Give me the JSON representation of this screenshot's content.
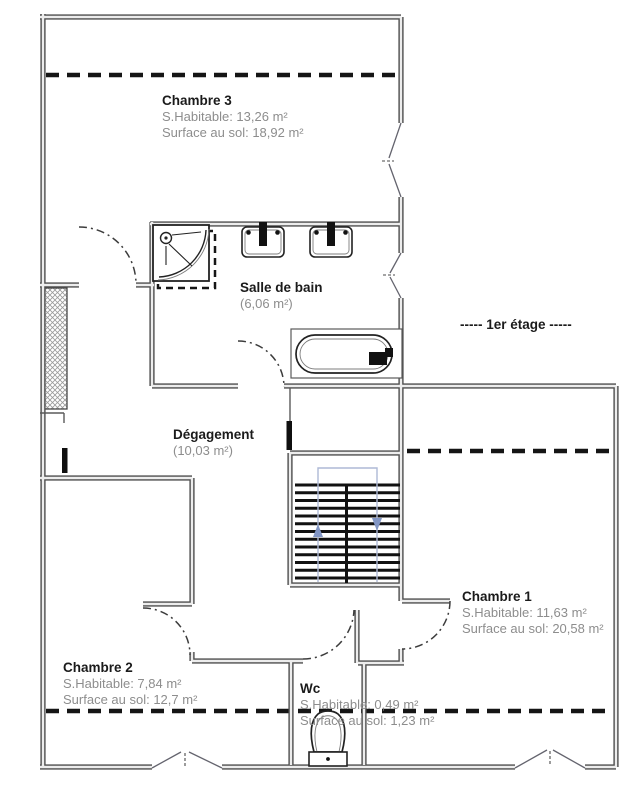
{
  "floor_label": "-----  1er étage  -----",
  "rooms": {
    "chambre3": {
      "name": "Chambre 3",
      "area_living": "S.Habitable: 13,26 m²",
      "area_floor": "Surface au sol: 18,92 m²"
    },
    "salle_de_bain": {
      "name": "Salle de bain",
      "area": "(6,06 m²)"
    },
    "degagement": {
      "name": "Dégagement",
      "area": "(10,03 m²)"
    },
    "chambre1": {
      "name": "Chambre 1",
      "area_living": "S.Habitable: 11,63 m²",
      "area_floor": "Surface au sol: 20,58 m²"
    },
    "chambre2": {
      "name": "Chambre 2",
      "area_living": "S.Habitable: 7,84 m²",
      "area_floor": "Surface au sol: 12,7 m²"
    },
    "wc": {
      "name": "Wc",
      "area_living": "S.Habitable: 0,49 m²",
      "area_floor": "Surface au sol: 1,23 m²"
    }
  },
  "colors": {
    "wall": "#4d4d4d",
    "attic_line": "#151515",
    "label_text": "#1b1b1b",
    "detail_text": "#8d8d8d",
    "stair_guide": "#aeb9d6"
  }
}
